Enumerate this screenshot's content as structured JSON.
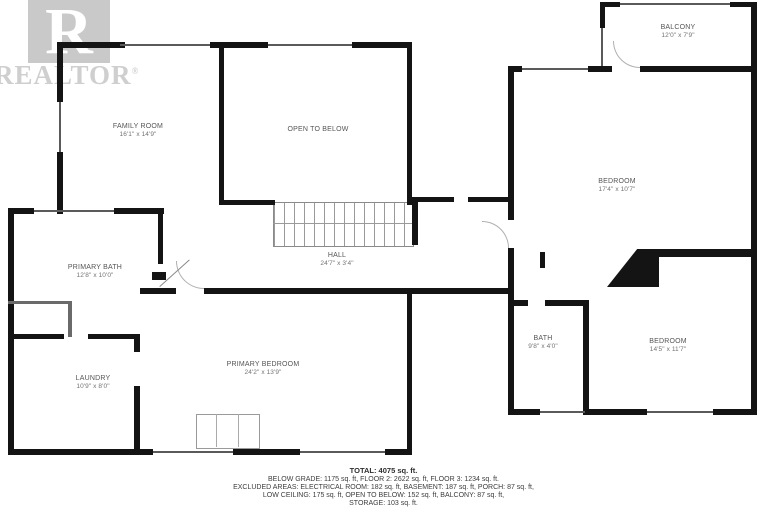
{
  "watermark": {
    "logo_letter": "R",
    "brand": "REALTOR",
    "registered": "®"
  },
  "rooms": {
    "family_room": {
      "name": "FAMILY ROOM",
      "dims": "16'1\" x 14'9\""
    },
    "open_to_below": {
      "name": "OPEN TO BELOW"
    },
    "balcony": {
      "name": "BALCONY",
      "dims": "12'0\" x 7'9\""
    },
    "bedroom_right": {
      "name": "BEDROOM",
      "dims": "17'4\" x 10'7\""
    },
    "primary_bath": {
      "name": "PRIMARY BATH",
      "dims": "12'8\" x 10'0\""
    },
    "hall": {
      "name": "HALL",
      "dims": "24'7\" x 3'4\""
    },
    "primary_bedroom": {
      "name": "PRIMARY BEDROOM",
      "dims": "24'2\" x 13'9\""
    },
    "laundry": {
      "name": "LAUNDRY",
      "dims": "10'9\" x 8'0\""
    },
    "bath": {
      "name": "BATH",
      "dims": "9'8\" x 4'0\""
    },
    "bedroom_bottom": {
      "name": "BEDROOM",
      "dims": "14'5\" x 11'7\""
    }
  },
  "footer": {
    "total": "TOTAL: 4075 sq. ft.",
    "line2": "BELOW GRADE: 1175 sq. ft, FLOOR 2: 2622 sq. ft, FLOOR 3: 1234 sq. ft.",
    "line3": "EXCLUDED AREAS: ELECTRICAL ROOM: 182 sq. ft, BASEMENT: 187 sq. ft, PORCH: 87 sq. ft,",
    "line4": "LOW CEILING: 175 sq. ft, OPEN TO BELOW: 152 sq. ft, BALCONY: 87 sq. ft,",
    "line5": "STORAGE: 103 sq. ft."
  },
  "colors": {
    "wall": "#141414",
    "label": "#555555",
    "watermark": "#cccccc",
    "stairs": "#9a9a9a"
  }
}
